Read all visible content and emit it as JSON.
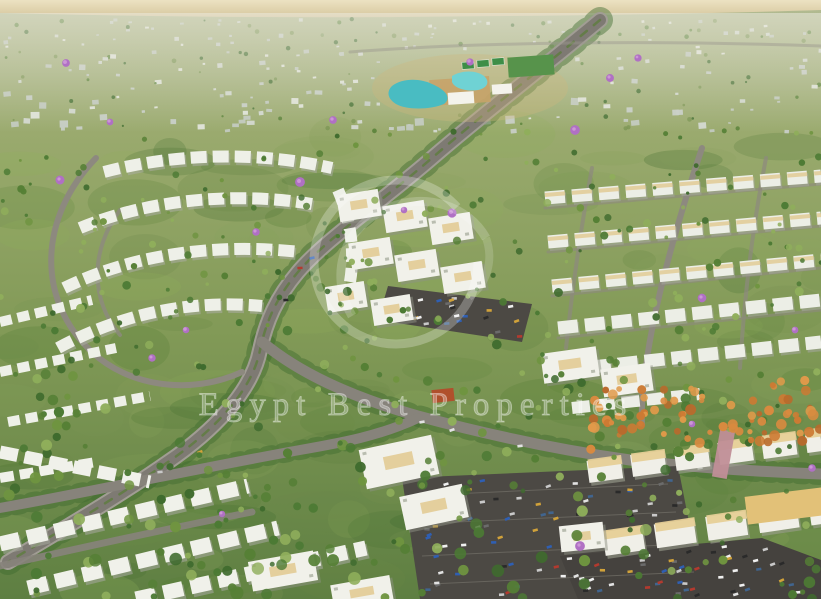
{
  "image": {
    "type": "aerial-masterplan-render",
    "description": "Aerial rendering of a master-planned residential community: curving tree-lined boulevards, clusters of white low-rise apartment buildings and townhouse rows, scattered purple jacaranda and orange flame trees, an amenity club area with turquoise lagoon pools and green sports courts, large surface parking lots filled with cars, and pale desert fields at the horizon."
  },
  "watermark": {
    "text": "Egypt Best Properties",
    "logo": "ring-monogram"
  },
  "palette": {
    "desert_horizon": "#ddd0a8",
    "desert_horizon_light": "#ece2c2",
    "haze": "#eceadf",
    "land_top": "#b3bb93",
    "land_mid": "#8aa05e",
    "land_low": "#6d8c4a",
    "land_bottom": "#5e7f42",
    "foliage_dark": "#3f6b2e",
    "foliage_mid": "#557f35",
    "foliage_light": "#8fae5b",
    "jacaranda": "#b070c4",
    "jacaranda_light": "#cf9ad8",
    "flame_tree": "#cc7a33",
    "road": "#827e76",
    "road_light": "#a19d94",
    "asphalt": "#4c4944",
    "asphalt_light": "#5a5751",
    "building_white": "#f1f1ea",
    "building_face": "#dfe2d8",
    "building_shadow": "#8e9183",
    "distant_block": "#d3d8d0",
    "roof_tan": "#e2cb95",
    "roof_gold": "#e2c178",
    "roof_red": "#b0502c",
    "pool": "#49bcc2",
    "pool_light": "#6fd2d4",
    "court_green": "#3e8e47",
    "field_green": "#57934b",
    "plaza_tan": "#c7a369",
    "pergola_pink": "#c08e97",
    "car_colors": [
      "#e2e2e2",
      "#2a2a2a",
      "#b33a2f",
      "#2f5fb3",
      "#c9c9c9",
      "#d1a23a",
      "#6b6b6b",
      "#f0f0f0",
      "#41658f"
    ]
  }
}
